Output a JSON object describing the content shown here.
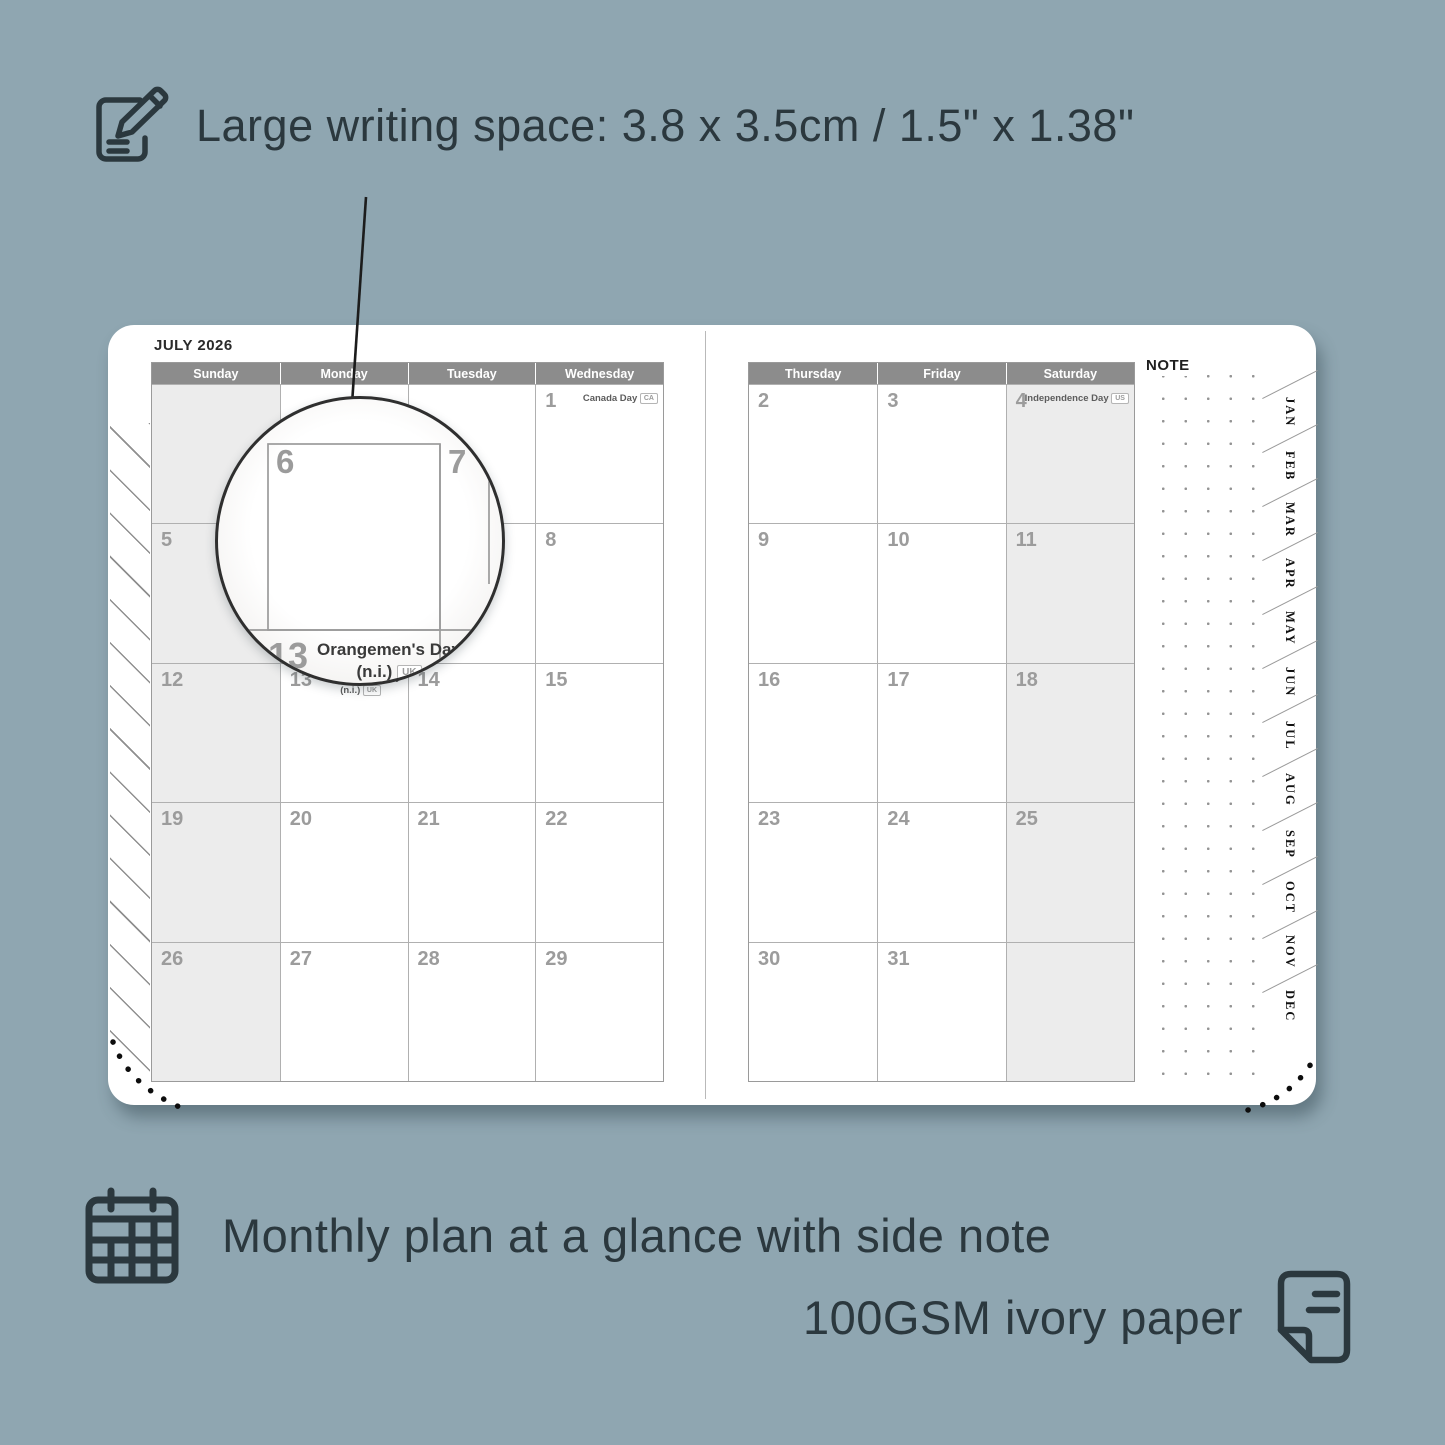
{
  "colors": {
    "background": "#8fa6b1",
    "ink": "#2b383e",
    "header_bar": "#8c8c8c",
    "weekend_fill": "#ececec",
    "date_gray": "#9c9c9c"
  },
  "feature_top": {
    "icon": "notepad-pencil-icon",
    "text": "Large writing space: 3.8 x 3.5cm / 1.5\" x 1.38\""
  },
  "planner": {
    "title": "JULY 2026",
    "note_label": "NOTE",
    "left_headers": [
      "Sunday",
      "Monday",
      "Tuesday",
      "Wednesday"
    ],
    "right_headers": [
      "Thursday",
      "Friday",
      "Saturday"
    ],
    "month_tabs": [
      "JAN",
      "FEB",
      "MAR",
      "APR",
      "MAY",
      "JUN",
      "JUL",
      "AUG",
      "SEP",
      "OCT",
      "NOV",
      "DEC"
    ],
    "left_weeks": [
      [
        {
          "d": ""
        },
        {
          "d": ""
        },
        {
          "d": ""
        },
        {
          "d": "1",
          "holiday": [
            "Canada Day"
          ],
          "badge": "CA"
        }
      ],
      [
        {
          "d": "5"
        },
        {
          "d": "6"
        },
        {
          "d": "7"
        },
        {
          "d": "8"
        }
      ],
      [
        {
          "d": "12"
        },
        {
          "d": "13",
          "holiday": [
            "Orangemen's Day",
            "(n.i.)"
          ],
          "badge": "UK"
        },
        {
          "d": "14"
        },
        {
          "d": "15"
        }
      ],
      [
        {
          "d": "19"
        },
        {
          "d": "20"
        },
        {
          "d": "21"
        },
        {
          "d": "22"
        }
      ],
      [
        {
          "d": "26"
        },
        {
          "d": "27"
        },
        {
          "d": "28"
        },
        {
          "d": "29"
        }
      ]
    ],
    "right_weeks": [
      [
        {
          "d": "2"
        },
        {
          "d": "3"
        },
        {
          "d": "4",
          "holiday": [
            "Independence Day"
          ],
          "badge": "US"
        }
      ],
      [
        {
          "d": "9"
        },
        {
          "d": "10"
        },
        {
          "d": "11"
        }
      ],
      [
        {
          "d": "16"
        },
        {
          "d": "17"
        },
        {
          "d": "18"
        }
      ],
      [
        {
          "d": "23"
        },
        {
          "d": "24"
        },
        {
          "d": "25"
        }
      ],
      [
        {
          "d": "30"
        },
        {
          "d": "31"
        },
        {
          "d": ""
        }
      ]
    ]
  },
  "magnifier": {
    "day_left": "6",
    "day_right": "7",
    "day_bottom": "13",
    "holiday_line1": "Orangemen's Day",
    "holiday_line2": "(n.i.)",
    "badge": "UK"
  },
  "feature_mid": {
    "icon": "calendar-grid-icon",
    "text": "Monthly plan at a glance with side note"
  },
  "feature_low": {
    "icon": "paper-icon",
    "text": "100GSM ivory paper"
  }
}
